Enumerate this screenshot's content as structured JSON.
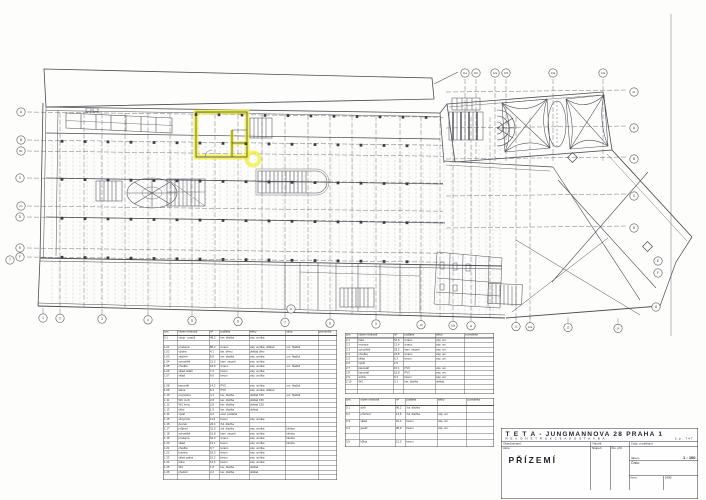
{
  "title_block": {
    "project": "T E T A   -   JUNGMANNOVA  28      PRAHA  1",
    "subtitle": "R E K O N S T R U K C E     A     D O S T A V B A",
    "house_no": "č.p. 747",
    "client_label": "Objednavatel:",
    "drawn_label": "Navrhl:",
    "resp_label": "Zodp. projektant",
    "date_label": "datum",
    "scale_value": "1 : 100",
    "stage_label": "Stupeň",
    "sheet_label": "Čís. příl.",
    "number_label": "Číslo:",
    "format_label": "form.",
    "year_value": "1980",
    "drawing_label": "Akce:",
    "drawing_name": "PŘÍZEMÍ"
  },
  "tables": {
    "central": {
      "headers": [
        "ozn.",
        "název místnosti",
        "m²",
        "podlaha",
        "stěny",
        "strop",
        "poznámka"
      ],
      "widths": [
        26,
        60,
        18,
        56,
        70,
        62,
        54
      ],
      "rows": [
        [
          "0.1",
          "vstup - pasáž",
          "48,2",
          "ker. dlažba",
          "váp. omítka",
          "",
          ""
        ],
        [
          "",
          "",
          "",
          "",
          "",
          "",
          ""
        ],
        [
          "1.01",
          "prodejna",
          "86,4",
          "teraco",
          "váp. omítka, obklad",
          "om. hladká",
          ""
        ],
        [
          "1.02",
          "výloha",
          "4,1",
          "lak. dřevo",
          "obklad dřev.",
          "",
          ""
        ],
        [
          "1.03",
          "zádveří",
          "6,8",
          "ker. dlažba",
          "váp. omítka",
          "om. hladká",
          ""
        ],
        [
          "1.04",
          "schodiště",
          "21,3",
          "kam. stupně",
          "váp. omítka",
          "",
          ""
        ],
        [
          "1.05",
          "chodba",
          "18,9",
          "teraco",
          "váp. omítka",
          "om. hladká",
          ""
        ],
        [
          "1.06",
          "sklad obalů",
          "7,2",
          "beton",
          "váp. omítka",
          "",
          ""
        ],
        [
          "1.07",
          "sklad",
          "9,6",
          "beton",
          "váp. omítka",
          "",
          ""
        ],
        [
          "",
          "",
          "",
          "",
          "",
          "",
          ""
        ],
        [
          "1.08",
          "kancelář",
          "14,2",
          "PVC",
          "váp. omítka",
          "om. hladká",
          ""
        ],
        [
          "1.09",
          "šatna",
          "8,4",
          "PVC",
          "váp. omítka, obklad",
          "",
          ""
        ],
        [
          "1.10",
          "umývárna",
          "4,1",
          "ker. dlažba",
          "obklad 150",
          "om. hladká",
          ""
        ],
        [
          "1.11",
          "WC muži",
          "2,8",
          "ker. dlažba",
          "obklad 150",
          "",
          ""
        ],
        [
          "1.12",
          "WC ženy",
          "2,8",
          "ker. dlažba",
          "obklad 150",
          "",
          ""
        ],
        [
          "1.13",
          "úklid",
          "1,9",
          "ker. dlažba",
          "obklad",
          "",
          ""
        ],
        [
          "1.14",
          "výtah",
          "3,2",
          "ocel. podlaha",
          "",
          "",
          ""
        ],
        [
          "1.15",
          "strojovna",
          "11,6",
          "beton",
          "váp. omítka",
          "",
          ""
        ],
        [
          "1.16",
          "dvorek",
          "22,4",
          "žul. dlažba",
          "",
          "",
          ""
        ],
        [
          "1.17",
          "průjezd",
          "31,0",
          "žul. dlažba",
          "váp. omítka",
          "klenba",
          ""
        ],
        [
          "1.18",
          "schodiště",
          "16,8",
          "kam. stupně",
          "váp. omítka",
          "klenba",
          ""
        ],
        [
          "1.19",
          "prodejna",
          "64,3",
          "teraco",
          "váp. omítka",
          "klenba",
          ""
        ],
        [
          "1.20",
          "sklad",
          "12,1",
          "beton",
          "váp. omítka",
          "klenba",
          ""
        ],
        [
          "1.21",
          "chodba",
          "9,7",
          "teraco",
          "váp. omítka",
          "",
          ""
        ],
        [
          "1.22",
          "kotelna",
          "18,3",
          "beton",
          "váp. omítka",
          "",
          ""
        ],
        [
          "1.23",
          "sklad paliva",
          "10,2",
          "beton",
          "váp. omítka",
          "",
          ""
        ],
        [
          "1.24",
          "dílna",
          "13,5",
          "beton",
          "váp. omítka",
          "",
          ""
        ],
        [
          "1.25",
          "WC",
          "1,8",
          "ker. dlažba",
          "obklad",
          "",
          ""
        ],
        [
          "1.26",
          "předsíň",
          "2,2",
          "ker. dlažba",
          "obklad",
          "",
          ""
        ],
        [
          "",
          "",
          "",
          "",
          "",
          "",
          ""
        ]
      ]
    },
    "right1": {
      "headers": [
        "ozn.",
        "název místnosti",
        "m²",
        "podlaha",
        "stěny",
        "poznámka"
      ],
      "widths": [
        22,
        68,
        18,
        60,
        56,
        72
      ],
      "rows": [
        [
          "2.1",
          "hala",
          "52,6",
          "teraco",
          "váp. om.",
          ""
        ],
        [
          "2.2",
          "recepce",
          "12,4",
          "teraco",
          "váp. om.",
          ""
        ],
        [
          "2.3",
          "schodiště",
          "18,2",
          "kam. stupně",
          "váp. om.",
          ""
        ],
        [
          "2.4",
          "chodba",
          "24,8",
          "teraco",
          "váp. om.",
          ""
        ],
        [
          "2.5",
          "sklad",
          "6,3",
          "beton",
          "váp. om.",
          ""
        ],
        [
          "2.6",
          "výtah",
          "2,9",
          "",
          "",
          ""
        ],
        [
          "2.7",
          "kancelář",
          "16,1",
          "PVC",
          "váp. om.",
          ""
        ],
        [
          "2.8",
          "kancelář",
          "15,8",
          "PVC",
          "váp. om.",
          ""
        ],
        [
          "2.9",
          "archiv",
          "9,4",
          "beton",
          "váp. om.",
          ""
        ],
        [
          "2.10",
          "WC",
          "3,1",
          "ker. dlažba",
          "obklad",
          ""
        ],
        [
          "",
          "",
          "",
          "",
          "",
          ""
        ],
        [
          "",
          "",
          "",
          "",
          "",
          ""
        ]
      ]
    },
    "right2": {
      "headers": [
        "ozn.",
        "název místnosti",
        "m²",
        "podlaha",
        "stěny",
        "poznámka"
      ],
      "widths": [
        26,
        68,
        18,
        60,
        56,
        68
      ],
      "rows": [
        [
          "3.1",
          "dvůr",
          "96,2",
          "žul. dlažba",
          "",
          ""
        ],
        [
          "3.2",
          "průchod",
          "14,6",
          "žul. dlažba",
          "váp. om.",
          ""
        ],
        [
          "3.3",
          "sklad",
          "22,4",
          "beton",
          "váp. om.",
          ""
        ],
        [
          "3.4",
          "garáž",
          "28,9",
          "beton",
          "váp. om.",
          ""
        ],
        [
          "",
          "",
          "",
          "",
          "",
          ""
        ],
        [
          "3.5",
          "kůlna",
          "12,2",
          "beton",
          "",
          ""
        ]
      ]
    }
  },
  "drawing": {
    "highlight_color": "#f0ec2e",
    "ink": "#4a4a52",
    "bubbles_left": [
      {
        "l": "A",
        "x": 21,
        "y": 112
      },
      {
        "l": "B",
        "x": 21,
        "y": 140
      },
      {
        "l": "B1",
        "x": 21,
        "y": 151
      },
      {
        "l": "C",
        "x": 20,
        "y": 178
      },
      {
        "l": "C1",
        "x": 21,
        "y": 206
      },
      {
        "l": "D",
        "x": 20,
        "y": 217
      },
      {
        "l": "E",
        "x": 20,
        "y": 248
      },
      {
        "l": "F",
        "x": 20,
        "y": 257
      }
    ],
    "bubbles_right": [
      {
        "l": "A1",
        "x": 634,
        "y": 92
      },
      {
        "l": "A",
        "x": 634,
        "y": 128
      },
      {
        "l": "B",
        "x": 634,
        "y": 159
      },
      {
        "l": "C",
        "x": 634,
        "y": 196
      },
      {
        "l": "D",
        "x": 634,
        "y": 228
      },
      {
        "l": "E",
        "x": 658,
        "y": 261
      },
      {
        "l": "F",
        "x": 658,
        "y": 273
      },
      {
        "l": "G",
        "x": 656,
        "y": 307
      }
    ],
    "bubbles_bottom": [
      {
        "l": "1",
        "x": 43
      },
      {
        "l": "2",
        "x": 60
      },
      {
        "l": "3",
        "x": 102
      },
      {
        "l": "4",
        "x": 148
      },
      {
        "l": "5",
        "x": 192
      },
      {
        "l": "6",
        "x": 238
      },
      {
        "l": "7",
        "x": 285
      },
      {
        "l": "8",
        "x": 330
      },
      {
        "l": "9",
        "x": 376
      },
      {
        "l": "10",
        "x": 421
      },
      {
        "l": "10a",
        "x": 453
      },
      {
        "l": "11",
        "x": 471
      },
      {
        "l": "12",
        "x": 516
      },
      {
        "l": "12a",
        "x": 530
      },
      {
        "l": "13",
        "x": 568
      },
      {
        "l": "14",
        "x": 618
      }
    ],
    "bubbles_top": [
      {
        "l": "11a",
        "x": 465
      },
      {
        "l": "11b",
        "x": 476
      },
      {
        "l": "12a",
        "x": 495
      },
      {
        "l": "12b",
        "x": 506
      },
      {
        "l": "13a",
        "x": 553
      },
      {
        "l": "14a",
        "x": 603
      }
    ],
    "bubbles_inline": [
      {
        "l": "7",
        "x": 10,
        "y": 260
      },
      {
        "l": "11",
        "x": 291,
        "y": 309
      }
    ],
    "grid_vertical_x": [
      60,
      84,
      102,
      125,
      148,
      170,
      192,
      215,
      238,
      262,
      285,
      308,
      330,
      352,
      376,
      400,
      421,
      440,
      453,
      471,
      490,
      516,
      530
    ],
    "grid_horizontal_left_y": [
      112,
      140,
      151,
      178,
      206,
      217,
      248,
      257
    ],
    "grid_horizontal_right_y": [
      92,
      128,
      159,
      196,
      228
    ],
    "texture": {
      "x0": 52,
      "x1": 500,
      "step": 7
    },
    "column_rows_y": [
      141,
      179,
      218,
      257
    ]
  }
}
